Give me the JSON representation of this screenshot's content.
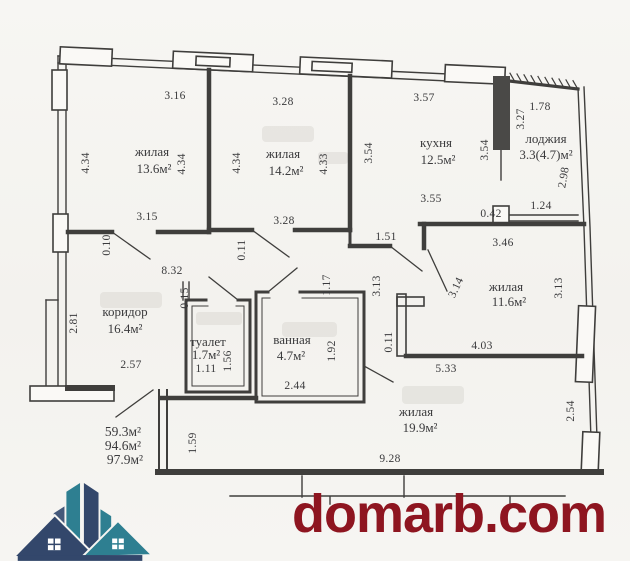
{
  "footer": {
    "site_label": "domarb.com",
    "brand_color": "#8e1520",
    "logo_colors": {
      "navy": "#33476b",
      "teal": "#2e7f91",
      "slate": "#45597a"
    }
  },
  "plan": {
    "type": "apartment-floor-plan",
    "rooms": [
      {
        "name": "жилая",
        "area": "13.6м²"
      },
      {
        "name": "жилая",
        "area": "14.2м²"
      },
      {
        "name": "кухня",
        "area": "12.5м²"
      },
      {
        "name": "лоджия",
        "area": "3.3(4.7)м²"
      },
      {
        "name": "коридор",
        "area": "16.4м²"
      },
      {
        "name": "туалет",
        "area": "1.7м²"
      },
      {
        "name": "ванная",
        "area": "4.7м²"
      },
      {
        "name": "жилая",
        "area": "11.6м²"
      },
      {
        "name": "жилая",
        "area": "19.9м²"
      }
    ],
    "totals": [
      "59.3м²",
      "94.6м²",
      "97.9м²"
    ],
    "labels": [
      {
        "t": "3.16",
        "x": 175,
        "y": 99
      },
      {
        "t": "3.28",
        "x": 283,
        "y": 105
      },
      {
        "t": "3.57",
        "x": 424,
        "y": 101
      },
      {
        "t": "1.78",
        "x": 540,
        "y": 110
      },
      {
        "t": "3.15",
        "x": 147,
        "y": 220
      },
      {
        "t": "3.28",
        "x": 284,
        "y": 224
      },
      {
        "t": "1.51",
        "x": 386,
        "y": 240
      },
      {
        "t": "3.55",
        "x": 431,
        "y": 202
      },
      {
        "t": "0.42",
        "x": 491,
        "y": 217
      },
      {
        "t": "1.24",
        "x": 541,
        "y": 209
      },
      {
        "t": "3.46",
        "x": 503,
        "y": 246
      },
      {
        "t": "8.32",
        "x": 172,
        "y": 274
      },
      {
        "t": "2.57",
        "x": 131,
        "y": 368
      },
      {
        "t": "1.11",
        "x": 206,
        "y": 372
      },
      {
        "t": "2.44",
        "x": 295,
        "y": 389
      },
      {
        "t": "4.03",
        "x": 482,
        "y": 349
      },
      {
        "t": "5.33",
        "x": 446,
        "y": 372
      },
      {
        "t": "9.28",
        "x": 390,
        "y": 462
      },
      {
        "t": "4.34",
        "x": 89,
        "y": 163,
        "r": -90
      },
      {
        "t": "4.34",
        "x": 185,
        "y": 164,
        "r": -90
      },
      {
        "t": "4.34",
        "x": 240,
        "y": 163,
        "r": -90
      },
      {
        "t": "4.33",
        "x": 327,
        "y": 164,
        "r": -90
      },
      {
        "t": "3.54",
        "x": 372,
        "y": 153,
        "r": -90
      },
      {
        "t": "3.54",
        "x": 488,
        "y": 150,
        "r": -90
      },
      {
        "t": "3.27",
        "x": 524,
        "y": 119,
        "r": -90
      },
      {
        "t": "2.98",
        "x": 567,
        "y": 178,
        "r": -80
      },
      {
        "t": "0.10",
        "x": 110,
        "y": 245,
        "r": -90
      },
      {
        "t": "0.11",
        "x": 245,
        "y": 250,
        "r": -90
      },
      {
        "t": "2.81",
        "x": 77,
        "y": 323,
        "r": -90
      },
      {
        "t": "0.15",
        "x": 188,
        "y": 298,
        "r": -90
      },
      {
        "t": "1.56",
        "x": 231,
        "y": 361,
        "r": -90
      },
      {
        "t": "1.17",
        "x": 330,
        "y": 285,
        "r": -90
      },
      {
        "t": "3.13",
        "x": 380,
        "y": 286,
        "r": -90
      },
      {
        "t": "3.14",
        "x": 459,
        "y": 289,
        "r": -65
      },
      {
        "t": "3.13",
        "x": 562,
        "y": 288,
        "r": -90
      },
      {
        "t": "1.92",
        "x": 335,
        "y": 351,
        "r": -90
      },
      {
        "t": "0.11",
        "x": 392,
        "y": 342,
        "r": -90
      },
      {
        "t": "2.54",
        "x": 574,
        "y": 411,
        "r": -90
      },
      {
        "t": "1.59",
        "x": 196,
        "y": 443,
        "r": -90
      },
      {
        "t": "жилая",
        "x": 152,
        "y": 156,
        "k": "room-name"
      },
      {
        "t": "13.6м²",
        "x": 154,
        "y": 173,
        "k": "room-area"
      },
      {
        "t": "жилая",
        "x": 283,
        "y": 158,
        "k": "room-name"
      },
      {
        "t": "14.2м²",
        "x": 286,
        "y": 175,
        "k": "room-area"
      },
      {
        "t": "кухня",
        "x": 436,
        "y": 147,
        "k": "room-name"
      },
      {
        "t": "12.5м²",
        "x": 438,
        "y": 164,
        "k": "room-area"
      },
      {
        "t": "лоджия",
        "x": 546,
        "y": 143,
        "k": "room-name"
      },
      {
        "t": "3.3(4.7)м²",
        "x": 546,
        "y": 159,
        "k": "room-area"
      },
      {
        "t": "коридор",
        "x": 125,
        "y": 316,
        "k": "room-name"
      },
      {
        "t": "16.4м²",
        "x": 125,
        "y": 333,
        "k": "room-area"
      },
      {
        "t": "туалет",
        "x": 208,
        "y": 346,
        "k": "room-name"
      },
      {
        "t": "1.7м²",
        "x": 206,
        "y": 359,
        "k": "room-area"
      },
      {
        "t": "ванная",
        "x": 292,
        "y": 344,
        "k": "room-name"
      },
      {
        "t": "4.7м²",
        "x": 291,
        "y": 360,
        "k": "room-area"
      },
      {
        "t": "жилая",
        "x": 506,
        "y": 291,
        "k": "room-name"
      },
      {
        "t": "11.6м²",
        "x": 509,
        "y": 306,
        "k": "room-area"
      },
      {
        "t": "жилая",
        "x": 416,
        "y": 416,
        "k": "room-name"
      },
      {
        "t": "19.9м²",
        "x": 420,
        "y": 432,
        "k": "room-area"
      },
      {
        "t": "59.3м²",
        "x": 123,
        "y": 436,
        "k": "total"
      },
      {
        "t": "94.6м²",
        "x": 123,
        "y": 450,
        "k": "total"
      },
      {
        "t": "97.9м²",
        "x": 125,
        "y": 464,
        "k": "total"
      }
    ]
  }
}
